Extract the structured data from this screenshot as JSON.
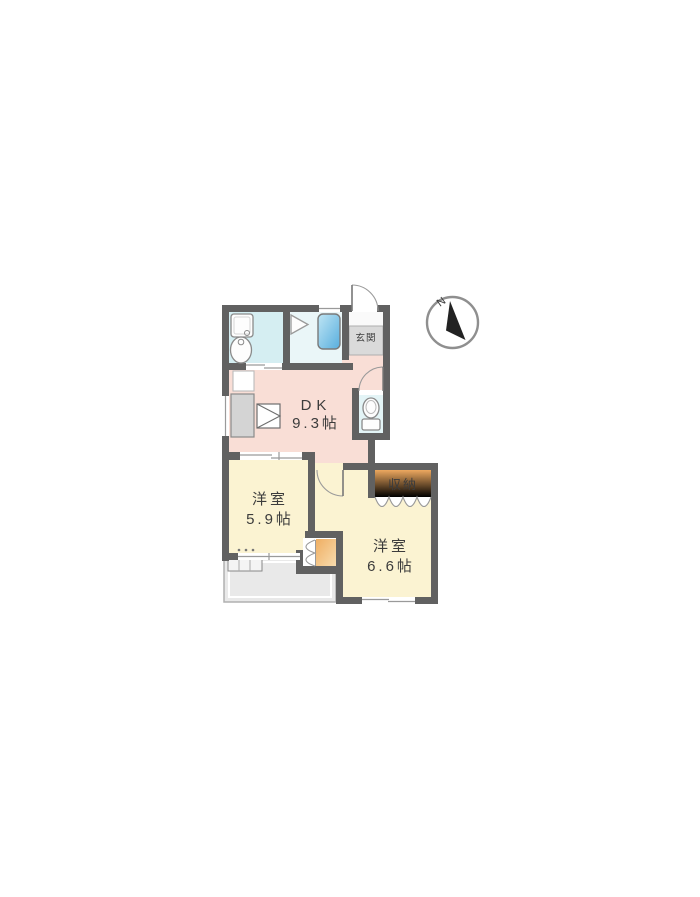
{
  "page": {
    "background": "#ffffff",
    "content": "apartment floor plan"
  },
  "floorplan": {
    "compass": {
      "label": "N"
    },
    "rooms": {
      "dk": {
        "name": "DK",
        "size": "9.3帖"
      },
      "bedroom_west": {
        "name": "洋室",
        "size": "5.9帖"
      },
      "bedroom_east": {
        "name": "洋室",
        "size": "6.6帖"
      },
      "storage": {
        "name": "収納"
      },
      "entrance": {
        "name": "玄関"
      }
    },
    "colors": {
      "wall": "#616161",
      "dk_floor": "#f9ded6",
      "bedroom_floor": "#fbf3d2",
      "wet_area_floor": "#d5eef2",
      "bath_floor": "#eaf6f8",
      "toilet_floor": "#e3f4f6",
      "bathtub": "#7fc6e6",
      "closet": "#f0b468",
      "balcony": "#e9e9e9",
      "entrance_floor": "#dadada"
    },
    "fixtures": [
      "bathtub",
      "washbasin",
      "washing-machine-pan",
      "toilet",
      "kitchen-counter",
      "refrigerator-space",
      "outdoor-unit"
    ]
  }
}
